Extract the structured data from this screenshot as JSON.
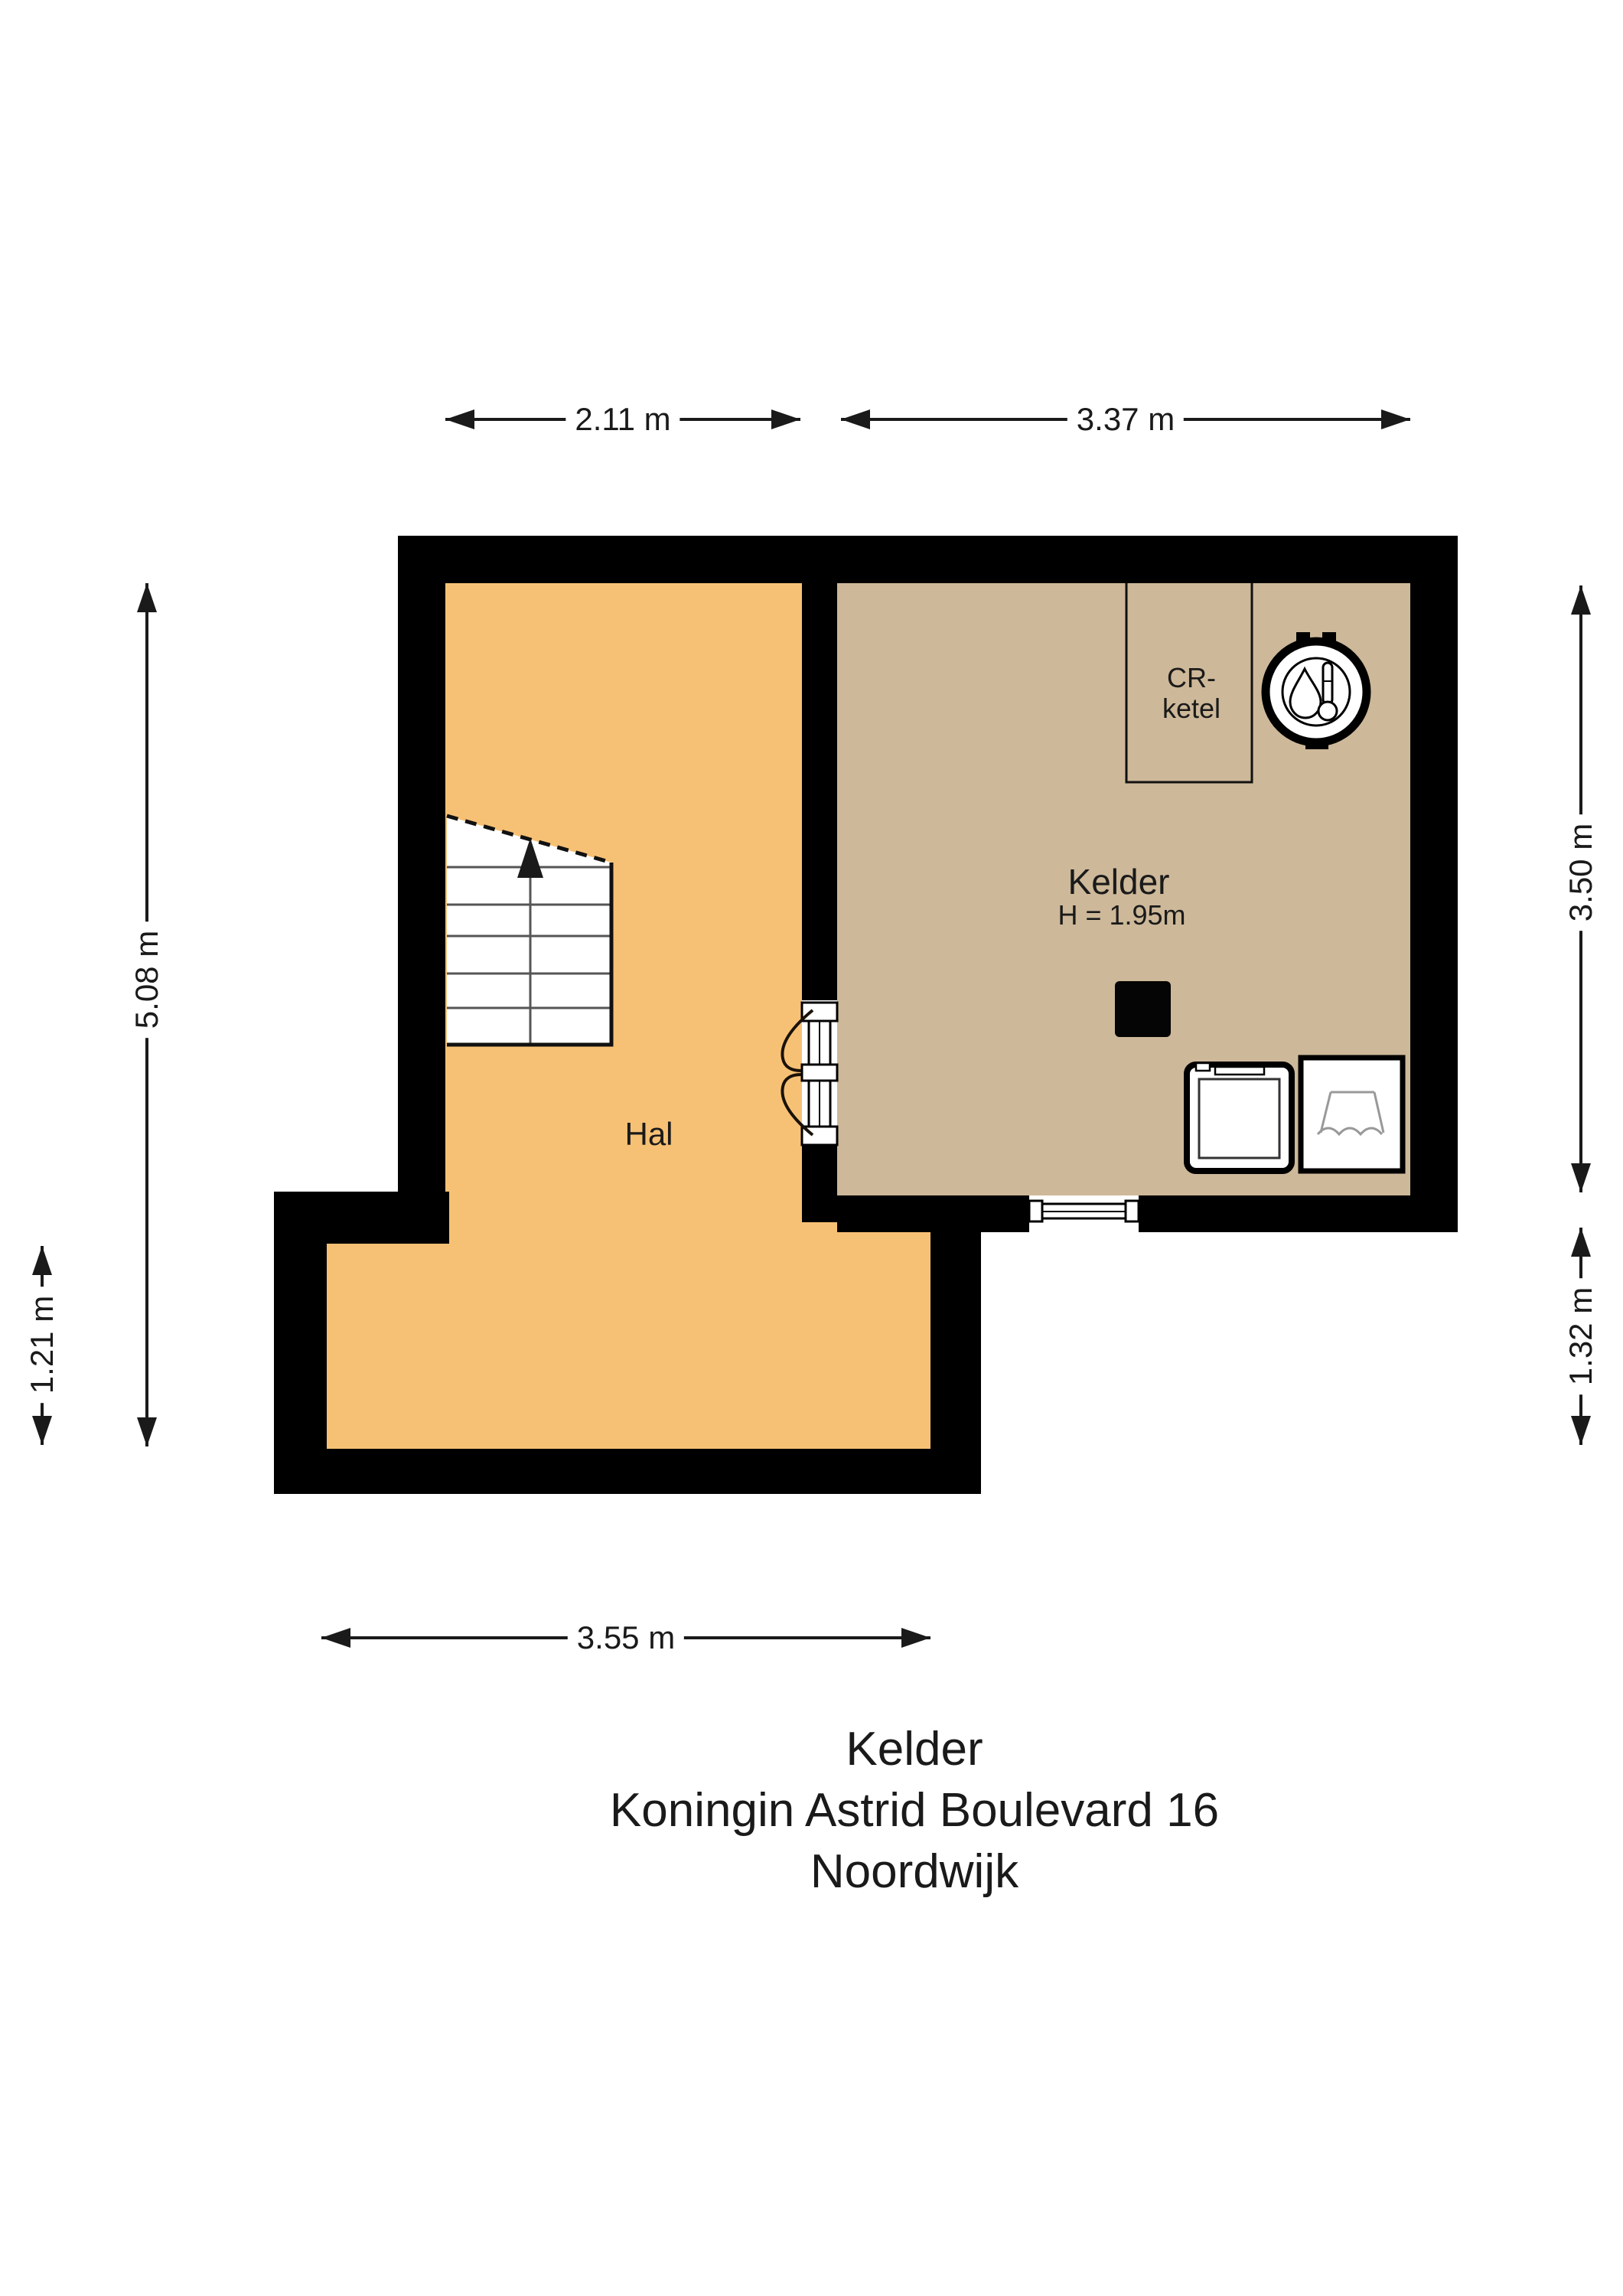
{
  "title": {
    "line1": "Kelder",
    "line2": "Koningin Astrid Boulevard 16",
    "line3": "Noordwijk"
  },
  "rooms": {
    "hal": {
      "label": "Hal"
    },
    "kelder": {
      "label": "Kelder",
      "ceiling_height": "H = 1.95m"
    },
    "cr_ketel": {
      "label_line1": "CR-",
      "label_line2": "ketel"
    }
  },
  "dimensions": {
    "hal_width": "2.11 m",
    "kelder_width": "3.37 m",
    "hal_height": "5.08 m",
    "step_height": "1.21 m",
    "kelder_height": "3.50 m",
    "lower_right_height": "1.32 m",
    "bottom_width": "3.55 m"
  },
  "icons": {
    "boiler": "boiler-thermometer-icon",
    "washing_machine": "washing-machine-icon",
    "sink": "sink-icon",
    "stairs_arrow": "stairs-up-arrow-icon"
  },
  "colors": {
    "wall": "#000000",
    "hal_floor": "#f7c175",
    "kelder_floor": "#cdb899",
    "background": "#ffffff",
    "stair_line": "#555555",
    "sink_line": "#999999"
  }
}
